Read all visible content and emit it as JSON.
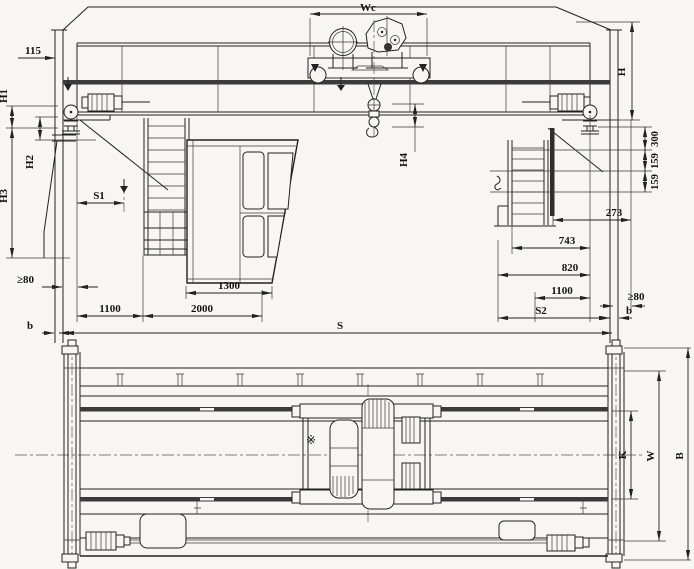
{
  "meta": {
    "drawing_type": "overhead-bridge-crane-general-arrangement",
    "views": [
      "front-elevation",
      "plan-view"
    ],
    "line_color": "#222222",
    "paper_color": "#f7f6f2",
    "rail_fill": "#3b3b3b"
  },
  "upper": {
    "wc": "Wc",
    "n115": "115",
    "h1": "H1",
    "h2": "H2",
    "h3": "H3",
    "s1": "S1",
    "h4": "H4",
    "h": "H",
    "v300": "300",
    "v159a": "159",
    "v159b": "159",
    "v273": "273",
    "v743": "743",
    "v820": "820",
    "v1100r": "1100",
    "gte80r": "≥80",
    "v1300": "1300",
    "gte80l": "≥80",
    "v1100l": "1100",
    "v2000": "2000",
    "bl": "b",
    "br": "b",
    "s2": "S2",
    "s": "S"
  },
  "lower": {
    "k": "K",
    "w": "W",
    "b": "B",
    "mark": "※"
  }
}
